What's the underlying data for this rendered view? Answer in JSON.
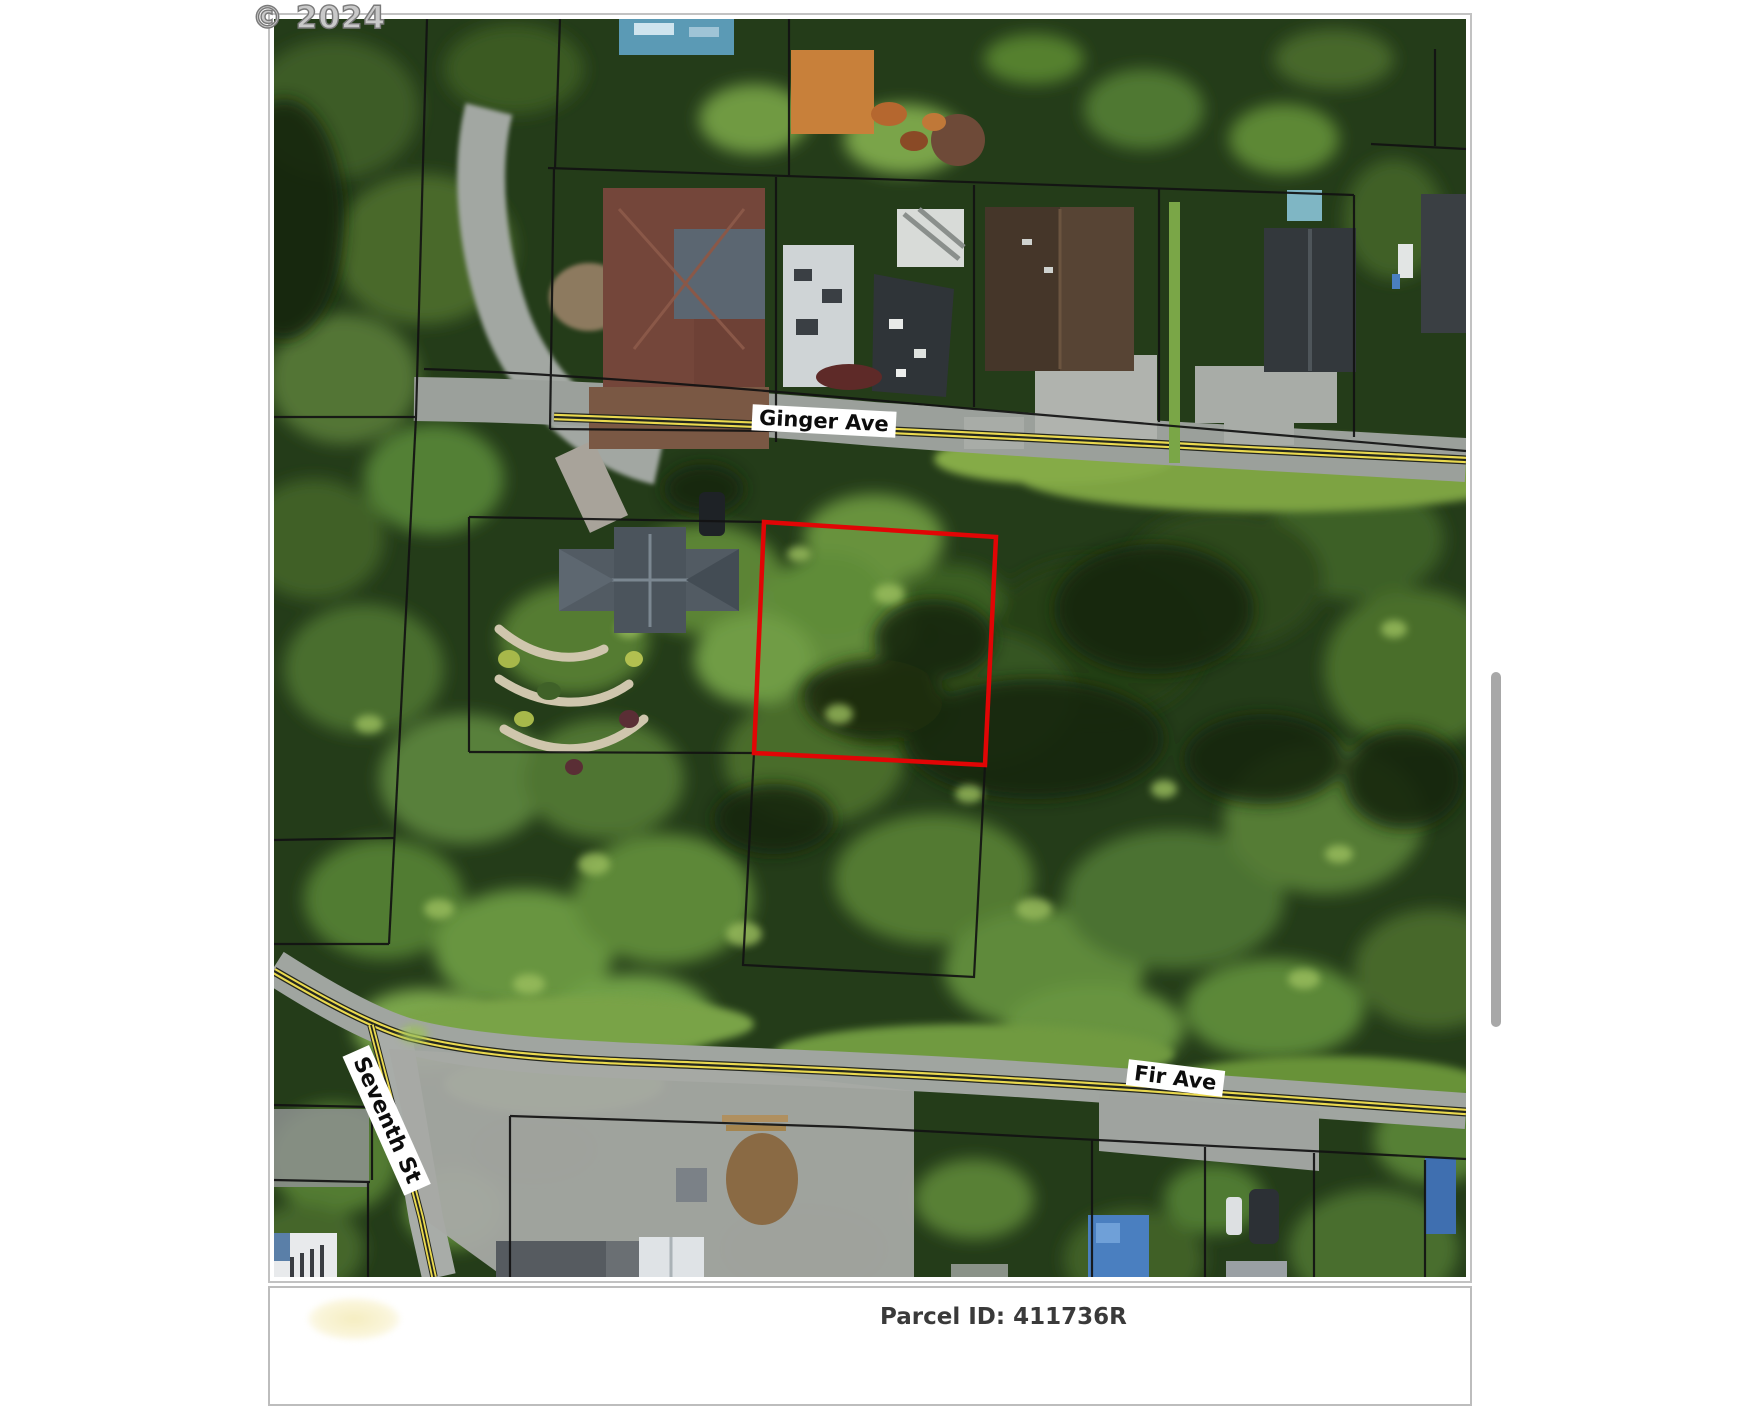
{
  "watermark": {
    "text": "© 2024"
  },
  "map": {
    "street_labels": {
      "ginger_ave": "Ginger Ave",
      "fir_ave": "Fir Ave",
      "seventh_st": "Seventh St"
    },
    "colors": {
      "highlight_parcel_outline": "#e10505",
      "parcel_boundary": "#121212",
      "road_centerline_yellow": "#ead94f",
      "road_surface": "#9ba09b",
      "forest_base": "#243c19"
    }
  },
  "details_panel": {
    "parcel_id_text": "Parcel ID: 411736R"
  }
}
